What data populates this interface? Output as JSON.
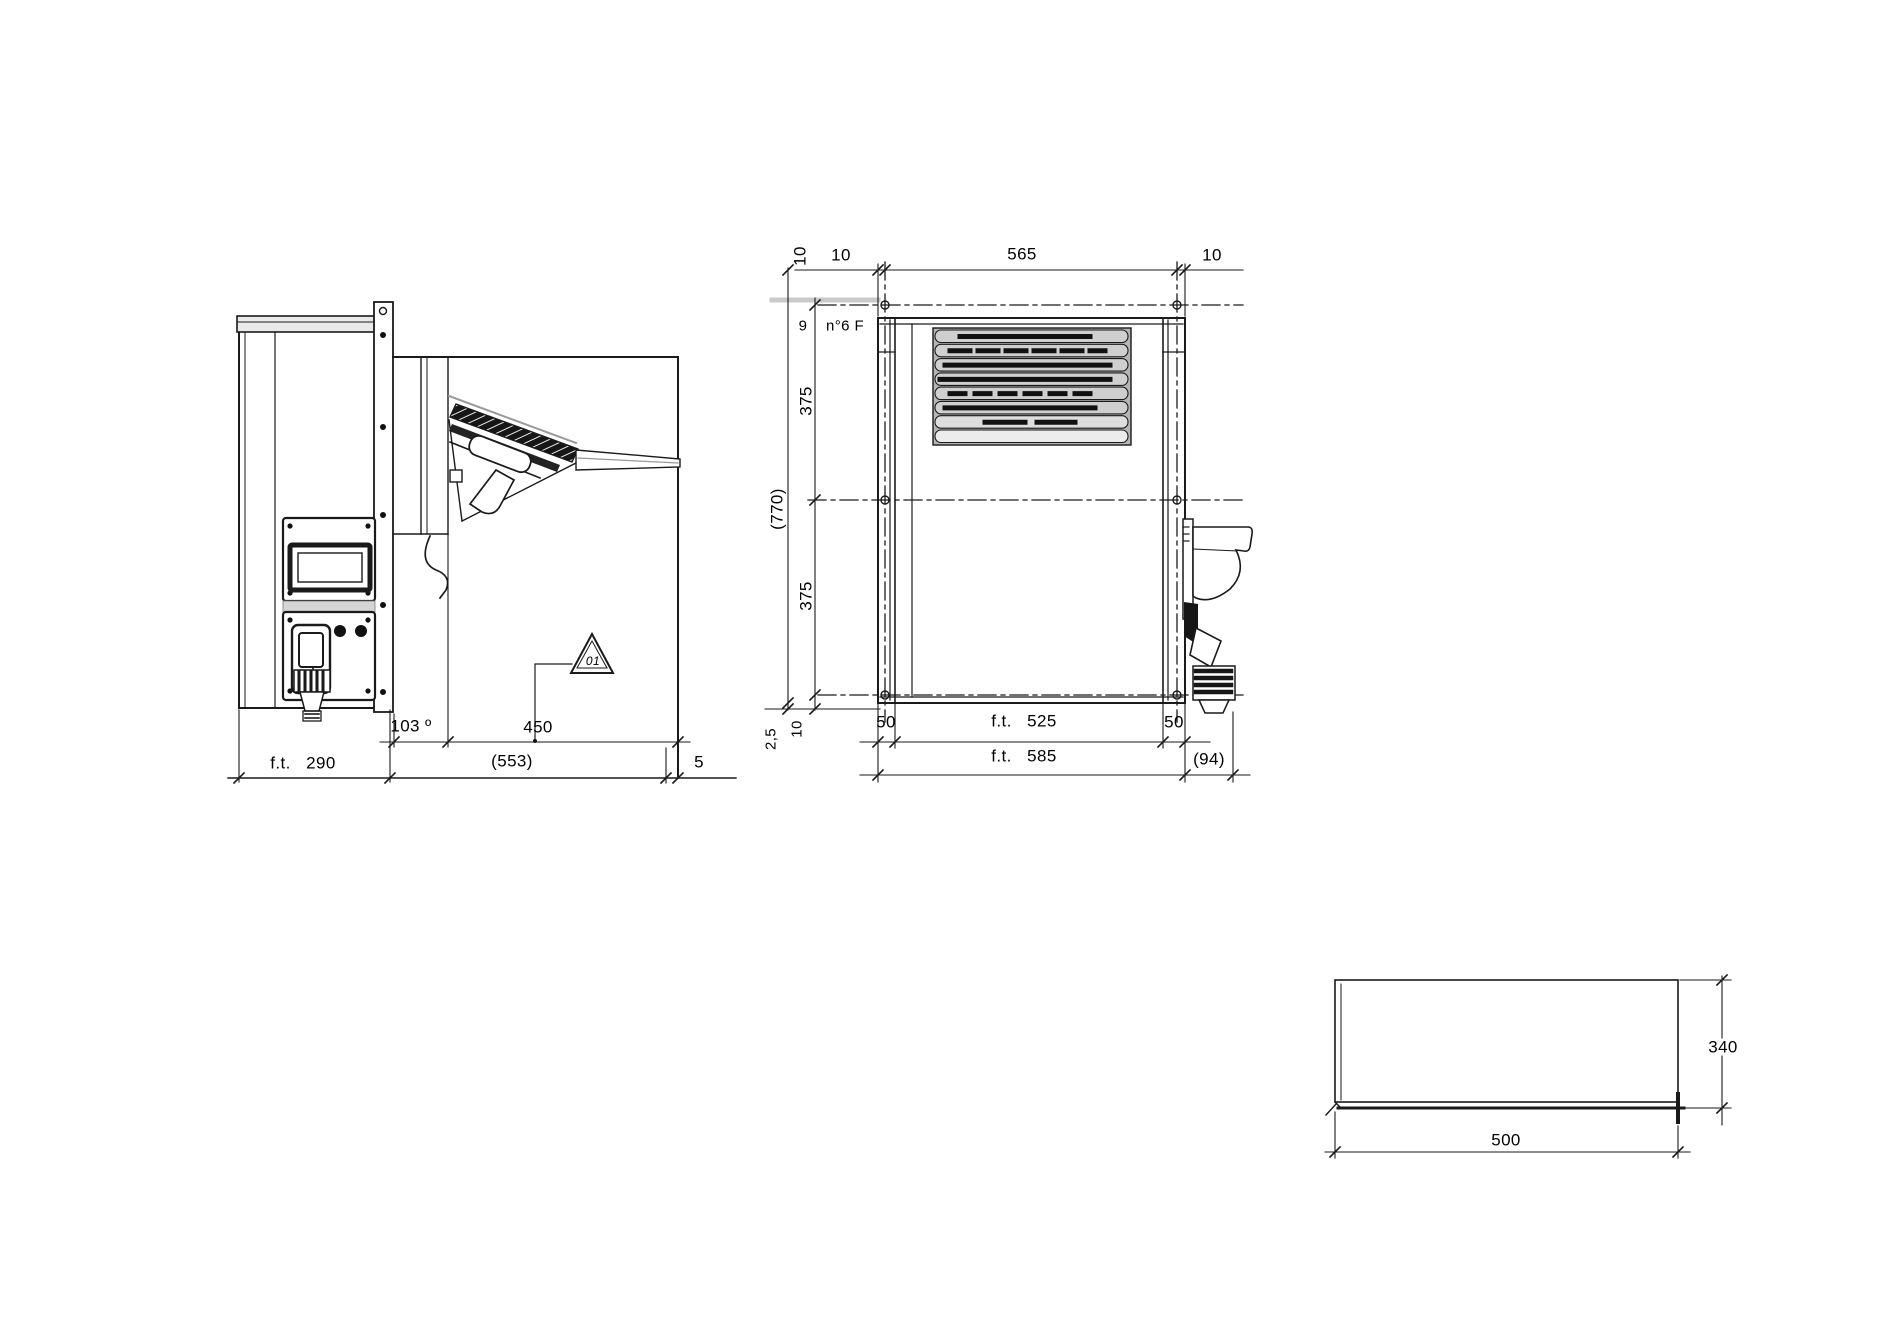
{
  "colors": {
    "background": "#ffffff",
    "line": "#1a1a1a",
    "grille_fill": "#c9c9c9",
    "panel_gray": "#d8d8d8"
  },
  "side_view": {
    "ft_depth": "f.t.   290",
    "wall_thickness": "103 º",
    "protrusion": "450",
    "internal_total": "(553)",
    "gap": "5",
    "warning_ref": "01"
  },
  "rear_view": {
    "top_offset_vert": "10",
    "top_left": "10",
    "hole_span": "565",
    "top_right": "10",
    "hole_dia": "9",
    "hole_note": "n°6 F",
    "total_height": "(770)",
    "row_top": "375",
    "row_bottom": "375",
    "bottom_gap": "2,5",
    "bottom_offset": "10",
    "inset_left": "50",
    "ft_inner": "f.t.   525",
    "inset_right": "50",
    "ft_width": "f.t.   585",
    "side_offset": "(94)"
  },
  "cutout_view": {
    "height": "340",
    "width": "500"
  }
}
